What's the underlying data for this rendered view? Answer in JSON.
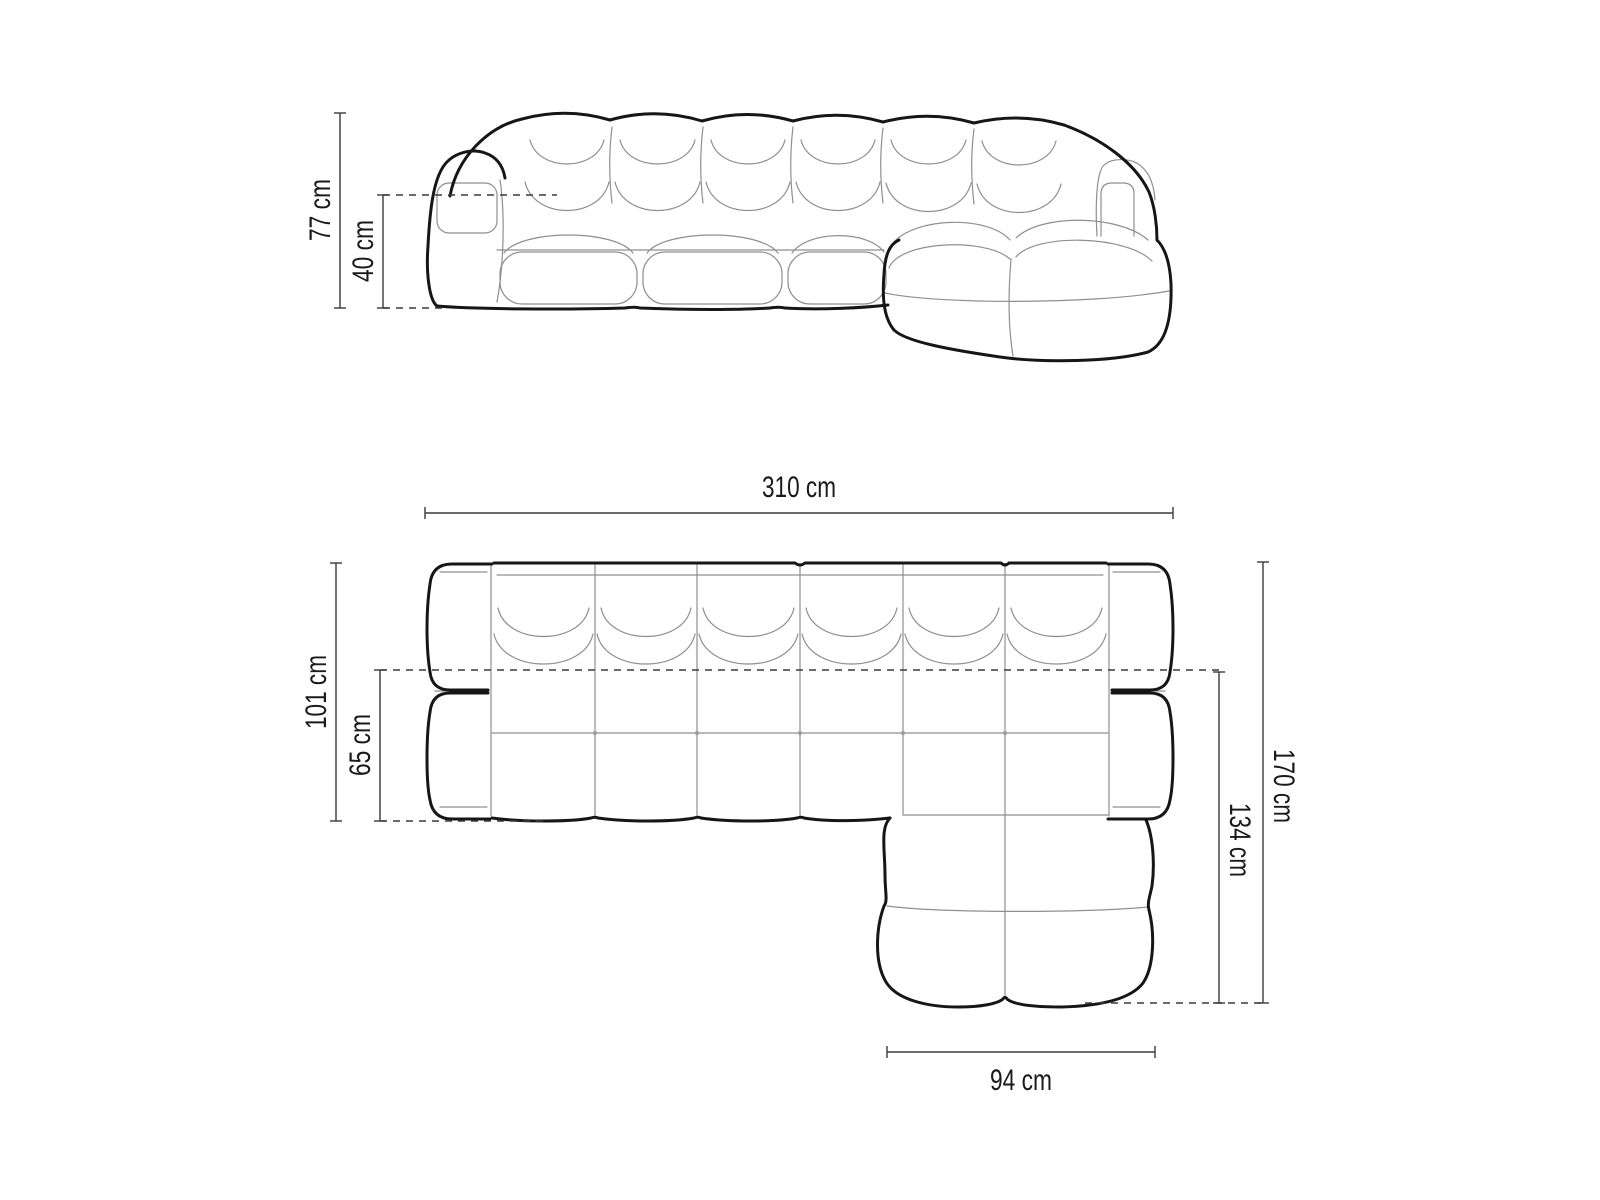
{
  "figure": {
    "type": "furniture-dimension-diagram",
    "subject": "modular corner sofa with right-hand chaise",
    "views": [
      "front elevation",
      "top plan"
    ],
    "units": "cm"
  },
  "labels": {
    "front_height": "77 cm",
    "front_seat_height": "40 cm",
    "width": "310 cm",
    "body_depth": "101 cm",
    "seat_depth": "65 cm",
    "total_depth": "170 cm",
    "chaise_length": "134 cm",
    "chaise_width": "94 cm"
  },
  "colors": {
    "background": "#ffffff",
    "outline": "#161616",
    "seam": "#8f8f8f",
    "dimension": "#3a3a3a",
    "text": "#1a1a1a"
  }
}
